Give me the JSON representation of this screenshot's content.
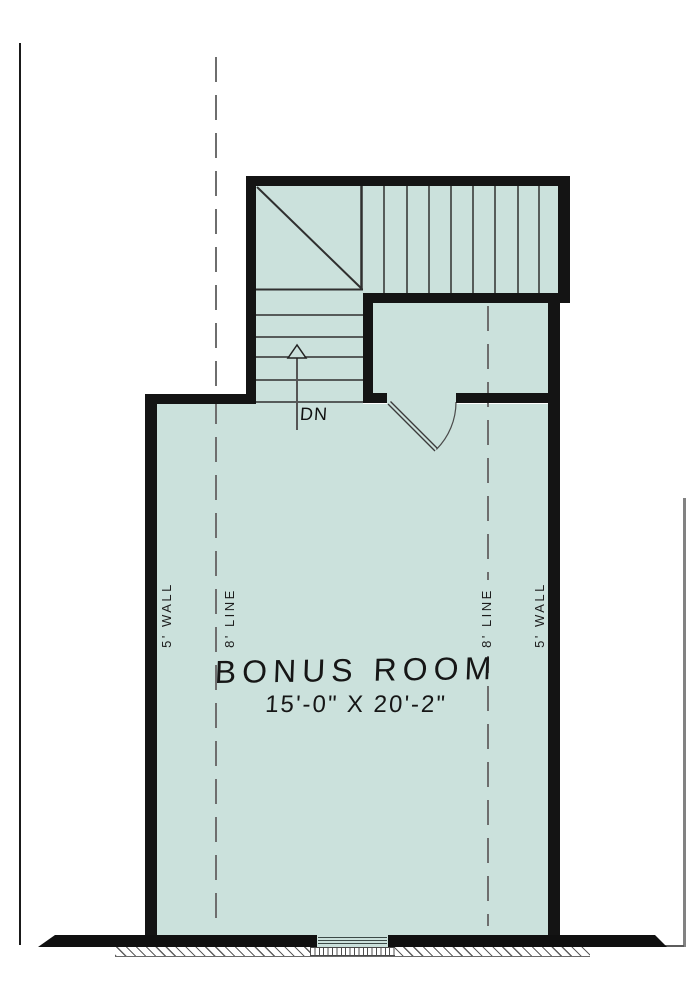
{
  "plan": {
    "room_label": "BONUS ROOM",
    "room_dimensions": "15'-0\" X 20'-2\"",
    "stair_direction_label": "DN",
    "left_wall_label": "5' WALL",
    "left_line_label": "8' LINE",
    "right_line_label": "8' LINE",
    "right_wall_label": "5' WALL"
  },
  "colors": {
    "floor_fill": "#cbe1dc",
    "wall": "#141414",
    "dashed_line": "#6e6e6e",
    "thin_linework": "#2f2f2f"
  },
  "icons": {
    "stair_arrow": "up-arrow"
  }
}
